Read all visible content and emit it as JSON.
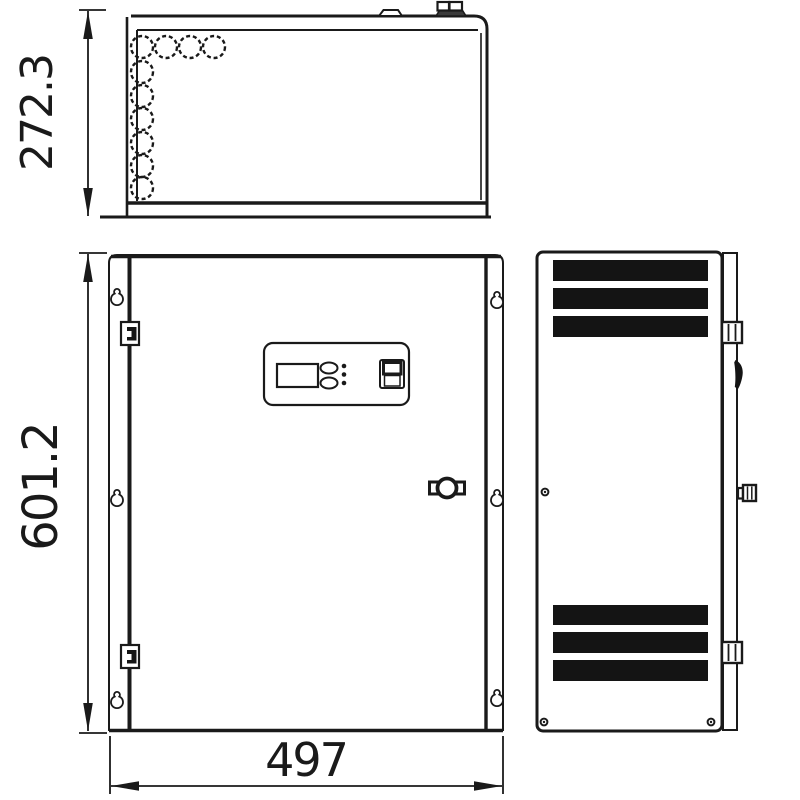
{
  "diagram": {
    "background_color": "#ffffff",
    "line_color": "#1a1a1a",
    "vent_fill_color": "#141414",
    "dimensions": {
      "top_view_height": "272.3",
      "front_view_height": "601.2",
      "front_view_width": "497"
    },
    "views": {
      "top": {
        "knockout_holes": 10,
        "top_tabs": 1,
        "gland_bolts": 1
      },
      "front": {
        "mounting_keyholes": 6,
        "hinges": 2,
        "lock": 1,
        "control_panel": {
          "display": 1,
          "oval_buttons": 2,
          "leds": 3,
          "key_switch": 1
        }
      },
      "side": {
        "vent_slots": 6,
        "hinge_blocks": 2,
        "latch": 1,
        "lever": 1,
        "screws": 3
      }
    }
  }
}
